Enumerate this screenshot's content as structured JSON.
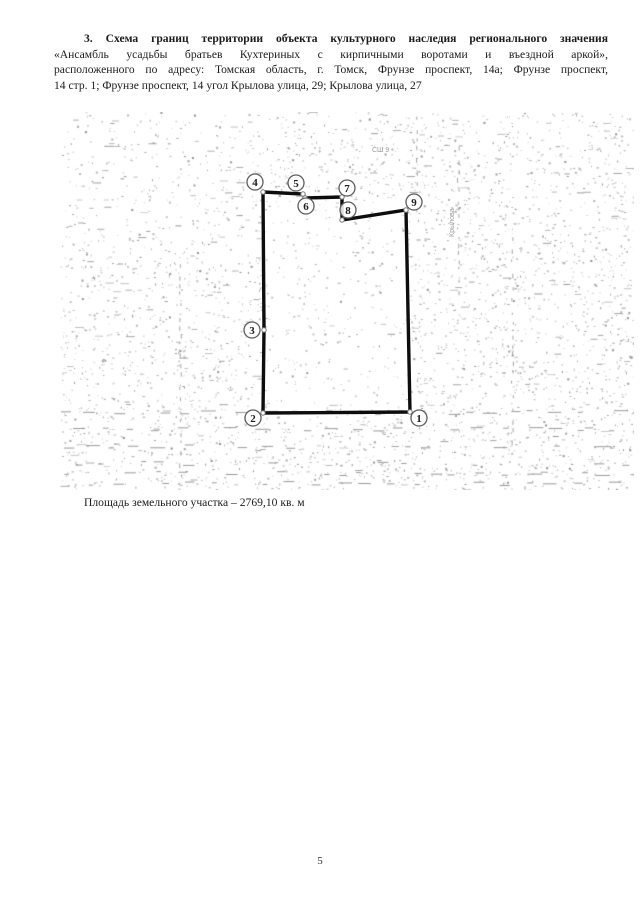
{
  "heading": {
    "lines": [
      "3.  Схема границ территории объекта культурного наследия регионального значения",
      "«Ансамбль усадьбы братьев Кухтериных с кирпичными воротами и въездной аркой»,",
      "расположенного по адресу: Томская область, г. Томск,  Фрунзе проспект, 14а; Фрунзе проспект,",
      "14 стр. 1; Фрунзе проспект, 14 угол Крылова улица, 29; Крылова улица, 27"
    ]
  },
  "map": {
    "boundary_color": "#0d0d0d",
    "noise_color": "#9e9e9e",
    "boundary_points": [
      {
        "x": 203,
        "y": 80
      },
      {
        "x": 243,
        "y": 82
      },
      {
        "x": 245,
        "y": 86
      },
      {
        "x": 282,
        "y": 85
      },
      {
        "x": 282,
        "y": 108
      },
      {
        "x": 346,
        "y": 98
      },
      {
        "x": 350,
        "y": 300
      },
      {
        "x": 203,
        "y": 301
      },
      {
        "x": 204,
        "y": 218
      }
    ],
    "vertex_badges": [
      {
        "n": "1",
        "x": 359,
        "y": 306
      },
      {
        "n": "2",
        "x": 193,
        "y": 306
      },
      {
        "n": "3",
        "x": 192,
        "y": 218
      },
      {
        "n": "4",
        "x": 195,
        "y": 70
      },
      {
        "n": "5",
        "x": 236,
        "y": 71
      },
      {
        "n": "6",
        "x": 246,
        "y": 94
      },
      {
        "n": "7",
        "x": 287,
        "y": 76
      },
      {
        "n": "8",
        "x": 288,
        "y": 98
      },
      {
        "n": "9",
        "x": 354,
        "y": 90
      }
    ],
    "annotations": [
      {
        "text": "СШ 9",
        "x": 312,
        "y": 40,
        "rotate": 0
      },
      {
        "text": "Крылова",
        "x": 394,
        "y": 125,
        "rotate": -90
      }
    ]
  },
  "area_caption": "Площадь земельного участка – 2769,10 кв. м",
  "page_number": "5"
}
